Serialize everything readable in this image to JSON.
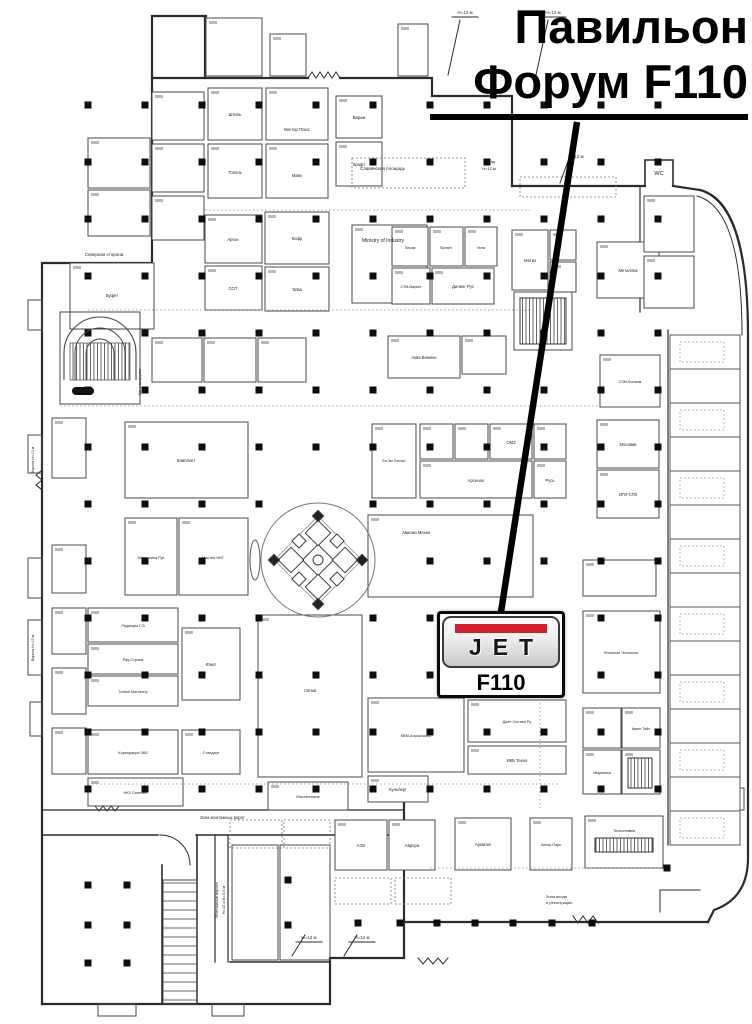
{
  "title": {
    "line1": "Павильон",
    "line2": "Форум F110"
  },
  "stand": {
    "brand": "JET",
    "number": "F110",
    "red": "#cf1f2f"
  },
  "callout": {
    "x1": 577,
    "y1": 122,
    "x2": 501,
    "y2": 612
  },
  "map": {
    "ink": "#2b2b2b",
    "booth_ink": "#4a4a4a",
    "walls": [
      {
        "d": "M205,16 L205,78"
      },
      {
        "d": "M152,16 L206,16"
      },
      {
        "d": "M152,16 L152,263 L42,263 L42,1004"
      },
      {
        "d": "M152,78 L308,78"
      },
      {
        "d": "M308,78 l4,-6 4,6 4,-6 4,6 4,-6 4,6 4,-6 4,6",
        "w": 1
      },
      {
        "d": "M340,78 L432,78 L432,96 L512,96 L512,186"
      },
      {
        "d": "M512,186 L645,186 M673,186 L700,190"
      },
      {
        "d": "M700,190 Q748,202 748,335 L748,858 Q748,898 714,910 L708,922"
      },
      {
        "d": "M697,196 Q742,208 742,335",
        "w": 1
      },
      {
        "d": "M708,922 L404,922"
      },
      {
        "d": "M573,916 l5,7 5,-7 5,7 5,-7 5,7",
        "w": 1
      },
      {
        "d": "M404,778 L404,958 L330,958 L330,1004 L42,1004"
      },
      {
        "d": "M42,810 L404,810",
        "w": 1.2
      },
      {
        "d": "M42,835 L158,835 M196,835 L404,835",
        "w": 1.6
      },
      {
        "d": "M160,835 A30,30 0 0 1 190,865",
        "w": 1
      },
      {
        "d": "M162,865 L162,1004",
        "w": 1.6
      },
      {
        "d": "M197,835 L197,1004",
        "w": 1.6
      },
      {
        "d": "M215,835 L215,962 M228,835 L228,962",
        "w": 1.2
      },
      {
        "d": "M230,962 L330,962",
        "w": 1.6
      },
      {
        "d": "M640,186 L640,312",
        "w": 1.2
      },
      {
        "d": "M668,330 L668,845",
        "w": 1.2
      },
      {
        "d": "M460,20 L448,75 M548,20 L536,75 M572,150 L560,183 M305,935 L292,956 M357,935 L344,956",
        "w": 1
      },
      {
        "d": "M452,17 L478,17 M540,17 L566,17 M296,942 L322,942 M349,942 L375,942",
        "w": 1
      },
      {
        "d": "M418,958 l5,6 5,-6 5,6 5,-6 5,6 5,-6",
        "w": 1
      },
      {
        "d": "M42,470 l-6,5 6,5 -6,5 6,5",
        "w": 1
      },
      {
        "d": "M660,890 L660,912 M660,890 L700,890",
        "w": 1
      },
      {
        "d": "M645,186 L645,160 L673,160 L673,186",
        "w": 1.6
      },
      {
        "d": "M95,806 l4,5 4,-5 4,5 4,-5 4,5 4,-5",
        "w": 1
      }
    ],
    "booths": [
      [
        152,
        92,
        52,
        48
      ],
      [
        152,
        144,
        52,
        48
      ],
      [
        152,
        196,
        52,
        44
      ],
      [
        88,
        138,
        62,
        50
      ],
      [
        88,
        190,
        62,
        46
      ],
      [
        70,
        263,
        84,
        66
      ],
      [
        208,
        88,
        54,
        52
      ],
      [
        266,
        88,
        62,
        52
      ],
      [
        336,
        96,
        46,
        42
      ],
      [
        208,
        144,
        54,
        54
      ],
      [
        266,
        144,
        62,
        54
      ],
      [
        336,
        142,
        46,
        44
      ],
      [
        206,
        18,
        56,
        58
      ],
      [
        270,
        34,
        36,
        42
      ],
      [
        398,
        24,
        30,
        52
      ],
      [
        205,
        215,
        57,
        48
      ],
      [
        205,
        266,
        57,
        44
      ],
      [
        265,
        212,
        64,
        52
      ],
      [
        265,
        267,
        64,
        44
      ],
      [
        352,
        225,
        75,
        78
      ],
      [
        392,
        227,
        36,
        39
      ],
      [
        430,
        227,
        33,
        39
      ],
      [
        465,
        227,
        32,
        39
      ],
      [
        392,
        268,
        38,
        36
      ],
      [
        432,
        268,
        62,
        36
      ],
      [
        512,
        230,
        36,
        60
      ],
      [
        550,
        230,
        26,
        30
      ],
      [
        550,
        262,
        26,
        30
      ],
      [
        597,
        242,
        62,
        56
      ],
      [
        644,
        196,
        50,
        56
      ],
      [
        644,
        256,
        50,
        52
      ],
      [
        600,
        355,
        60,
        52
      ],
      [
        597,
        420,
        62,
        48
      ],
      [
        597,
        470,
        62,
        48
      ],
      [
        152,
        338,
        50,
        44
      ],
      [
        204,
        338,
        52,
        44
      ],
      [
        258,
        338,
        48,
        44
      ],
      [
        388,
        336,
        72,
        42
      ],
      [
        462,
        336,
        44,
        38
      ],
      [
        125,
        422,
        123,
        76
      ],
      [
        125,
        518,
        52,
        77
      ],
      [
        179,
        518,
        69,
        77
      ],
      [
        52,
        418,
        34,
        60
      ],
      [
        52,
        545,
        34,
        48
      ],
      [
        52,
        608,
        34,
        46
      ],
      [
        52,
        668,
        34,
        46
      ],
      [
        52,
        728,
        34,
        46
      ],
      [
        88,
        608,
        90,
        34
      ],
      [
        88,
        644,
        90,
        30
      ],
      [
        88,
        676,
        90,
        30
      ],
      [
        182,
        628,
        58,
        72
      ],
      [
        88,
        730,
        90,
        44
      ],
      [
        182,
        730,
        58,
        44
      ],
      [
        88,
        778,
        95,
        28
      ],
      [
        268,
        782,
        80,
        28
      ],
      [
        258,
        615,
        104,
        162
      ],
      [
        368,
        515,
        165,
        82
      ],
      [
        372,
        424,
        44,
        74
      ],
      [
        420,
        424,
        33,
        35
      ],
      [
        455,
        424,
        33,
        35
      ],
      [
        490,
        424,
        42,
        35
      ],
      [
        420,
        461,
        112,
        37
      ],
      [
        534,
        461,
        32,
        37
      ],
      [
        534,
        424,
        32,
        35
      ],
      [
        583,
        560,
        73,
        36
      ],
      [
        583,
        611,
        77,
        82
      ],
      [
        583,
        708,
        38,
        40
      ],
      [
        622,
        708,
        38,
        40
      ],
      [
        583,
        750,
        38,
        44
      ],
      [
        622,
        750,
        38,
        44
      ],
      [
        368,
        698,
        96,
        74
      ],
      [
        468,
        700,
        98,
        42
      ],
      [
        368,
        776,
        60,
        26
      ],
      [
        468,
        746,
        98,
        28
      ],
      [
        335,
        820,
        52,
        50
      ],
      [
        389,
        820,
        46,
        50
      ],
      [
        455,
        818,
        56,
        52
      ],
      [
        530,
        818,
        42,
        52
      ],
      [
        585,
        816,
        78,
        52
      ],
      [
        700,
        788,
        44,
        22
      ]
    ],
    "plain": [
      [
        60,
        312,
        80,
        92
      ],
      [
        232,
        845,
        46,
        115
      ],
      [
        280,
        845,
        50,
        115
      ],
      [
        98,
        1004,
        38,
        12
      ],
      [
        212,
        1004,
        32,
        12
      ],
      [
        28,
        300,
        14,
        30
      ],
      [
        28,
        435,
        14,
        38
      ],
      [
        28,
        558,
        14,
        40
      ],
      [
        28,
        620,
        14,
        55
      ],
      [
        30,
        702,
        12,
        34
      ],
      [
        514,
        292,
        58,
        58
      ]
    ],
    "dashed": [
      [
        352,
        158,
        113,
        30
      ],
      [
        520,
        177,
        96,
        20
      ],
      [
        230,
        820,
        52,
        28
      ],
      [
        284,
        820,
        46,
        28
      ],
      [
        335,
        878,
        56,
        26
      ],
      [
        395,
        878,
        56,
        26
      ]
    ],
    "hatched": [
      [
        520,
        298,
        46,
        46
      ],
      [
        595,
        838,
        58,
        14
      ],
      [
        628,
        758,
        24,
        30
      ]
    ],
    "rungs": [
      [
        163,
        880,
        34,
        124
      ]
    ],
    "dotted": [
      [
        88,
        310,
        530,
        310
      ],
      [
        60,
        406,
        600,
        406
      ],
      [
        88,
        784,
        560,
        784
      ],
      [
        430,
        868,
        660,
        868
      ],
      [
        540,
        615,
        540,
        808
      ],
      [
        205,
        210,
        530,
        210
      ]
    ],
    "stalls": {
      "x": 670,
      "y0": 335,
      "w": 70,
      "h": 34,
      "count": 15
    },
    "pillars": {
      "xs": [
        88,
        145,
        202,
        259,
        316,
        373,
        430,
        487,
        544,
        601,
        658
      ],
      "ys": [
        105,
        162,
        219,
        276,
        333,
        390,
        447,
        504,
        561,
        618,
        675,
        732,
        789
      ],
      "extra": [
        [
          88,
          885
        ],
        [
          127,
          885
        ],
        [
          88,
          925
        ],
        [
          127,
          925
        ],
        [
          88,
          963
        ],
        [
          127,
          963
        ],
        [
          288,
          880
        ],
        [
          288,
          925
        ],
        [
          358,
          923
        ],
        [
          400,
          923
        ],
        [
          437,
          923
        ],
        [
          475,
          923
        ],
        [
          513,
          923
        ],
        [
          552,
          923
        ],
        [
          592,
          923
        ],
        [
          667,
          868
        ]
      ],
      "skip_center": {
        "cx": 318,
        "cy": 560,
        "r": 75
      }
    },
    "labels": [
      {
        "t": "Северная сторона",
        "x": 104,
        "y": 256,
        "s": 4.5
      },
      {
        "t": "Буфет",
        "x": 112,
        "y": 297
      },
      {
        "t": "Славянская площадь",
        "x": 360,
        "y": 170,
        "s": 4.5,
        "a": "start"
      },
      {
        "t": "Выезд",
        "x": 489,
        "y": 163,
        "s": 4
      },
      {
        "t": "H=12 м",
        "x": 489,
        "y": 170,
        "s": 4
      },
      {
        "t": "H=12 м",
        "x": 465,
        "y": 14,
        "s": 4.5
      },
      {
        "t": "H=12 м",
        "x": 553,
        "y": 14,
        "s": 4.5
      },
      {
        "t": "H=12 м",
        "x": 576,
        "y": 158,
        "s": 4.5
      },
      {
        "t": "H=12 м",
        "x": 309,
        "y": 939,
        "s": 4.5
      },
      {
        "t": "H=12 м",
        "x": 362,
        "y": 939,
        "s": 4.5
      },
      {
        "t": "WC",
        "x": 659,
        "y": 175,
        "s": 5.5
      },
      {
        "t": "Зона входа",
        "x": 546,
        "y": 898,
        "s": 4,
        "a": "start"
      },
      {
        "t": "и регистрации",
        "x": 546,
        "y": 904,
        "s": 4,
        "a": "start"
      },
      {
        "t": "Зона монтажных ворот",
        "x": 200,
        "y": 819,
        "s": 4.2,
        "a": "start"
      },
      {
        "t": "Монтажные ворота",
        "x": 218,
        "y": 900,
        "s": 4,
        "r": -90
      },
      {
        "t": "H=12 и B=3,5 м",
        "x": 225,
        "y": 900,
        "s": 4,
        "r": -90
      },
      {
        "t": "Зона выгрузки",
        "x": 141,
        "y": 382,
        "s": 4,
        "r": -90
      },
      {
        "t": "Ворота H=12 м",
        "x": 34,
        "y": 460,
        "s": 3.8,
        "r": -90
      },
      {
        "t": "Ворота H=12 м",
        "x": 34,
        "y": 648,
        "s": 3.8,
        "r": -90
      },
      {
        "t": "Ministry of Industry",
        "x": 362,
        "y": 242,
        "s": 5,
        "a": "start"
      },
      {
        "t": "Штиль",
        "x": 235,
        "y": 116
      },
      {
        "t": "Вектор Плюс",
        "x": 297,
        "y": 131
      },
      {
        "t": "Вираж",
        "x": 359,
        "y": 119
      },
      {
        "t": "Тополь",
        "x": 235,
        "y": 174
      },
      {
        "t": "Маяк",
        "x": 297,
        "y": 177
      },
      {
        "t": "Крафт",
        "x": 359,
        "y": 166
      },
      {
        "t": "Аргон",
        "x": 233,
        "y": 241
      },
      {
        "t": "Кофр",
        "x": 297,
        "y": 240
      },
      {
        "t": "СОТ",
        "x": 233,
        "y": 290
      },
      {
        "t": "Элва",
        "x": 297,
        "y": 291
      },
      {
        "t": "Элком",
        "x": 410,
        "y": 249,
        "s": 3.6
      },
      {
        "t": "Палант",
        "x": 446,
        "y": 249,
        "s": 3.6
      },
      {
        "t": "Нота",
        "x": 481,
        "y": 249,
        "s": 3.6
      },
      {
        "t": "СТМ-Маркет",
        "x": 411,
        "y": 288,
        "s": 3.6
      },
      {
        "t": "Дилинг Рус",
        "x": 463,
        "y": 288
      },
      {
        "t": "Метиз",
        "x": 530,
        "y": 262
      },
      {
        "t": "Металлик",
        "x": 628,
        "y": 272
      },
      {
        "t": "СЗМ-Консим",
        "x": 630,
        "y": 383,
        "s": 3.8
      },
      {
        "t": "Мосавив",
        "x": 628,
        "y": 446
      },
      {
        "t": "ИГИ-СПб",
        "x": 628,
        "y": 496
      },
      {
        "t": "Аква Вижион",
        "x": 424,
        "y": 359
      },
      {
        "t": "Комплект",
        "x": 186,
        "y": 462
      },
      {
        "t": "Металлика Рус",
        "x": 151,
        "y": 559,
        "s": 3.8
      },
      {
        "t": "Мастен-НБТ",
        "x": 213,
        "y": 559,
        "s": 3.8
      },
      {
        "t": "Би-Эм Сигнал",
        "x": 394,
        "y": 462,
        "s": 3.5
      },
      {
        "t": "Арсенал",
        "x": 476,
        "y": 482
      },
      {
        "t": "Русь",
        "x": 550,
        "y": 482
      },
      {
        "t": "ОМЗ",
        "x": 511,
        "y": 444
      },
      {
        "t": "Ависма Механ",
        "x": 402,
        "y": 534,
        "a": "start"
      },
      {
        "t": "Сигма",
        "x": 310,
        "y": 692
      },
      {
        "t": "Редакция СЭ",
        "x": 133,
        "y": 627,
        "s": 3.8
      },
      {
        "t": "Рау-Строев",
        "x": 133,
        "y": 661,
        "s": 3.8
      },
      {
        "t": "Turkish Machinery",
        "x": 133,
        "y": 693,
        "s": 3.6
      },
      {
        "t": "Юнит",
        "x": 211,
        "y": 666
      },
      {
        "t": "Корпорация ЗКБ",
        "x": 133,
        "y": 754,
        "s": 3.8
      },
      {
        "t": "Стандарт",
        "x": 211,
        "y": 754,
        "s": 3.8
      },
      {
        "t": "НКЗ Сантехн",
        "x": 135,
        "y": 794,
        "s": 3.8
      },
      {
        "t": "Мастенников",
        "x": 308,
        "y": 798,
        "s": 3.8
      },
      {
        "t": "КВМ-Аэрокосмос",
        "x": 416,
        "y": 737,
        "s": 3.8
      },
      {
        "t": "Джет Систем Ру",
        "x": 517,
        "y": 723,
        "s": 3.8
      },
      {
        "t": "Кульберг",
        "x": 398,
        "y": 791
      },
      {
        "t": "ИКБ Техно",
        "x": 517,
        "y": 762
      },
      {
        "t": "Легальные Технологии",
        "x": 621,
        "y": 654,
        "s": 3.2
      },
      {
        "t": "Авант Тайл",
        "x": 641,
        "y": 730,
        "s": 3.5
      },
      {
        "t": "Медиатика",
        "x": 602,
        "y": 774,
        "s": 3.5
      },
      {
        "t": "АЭЗ",
        "x": 361,
        "y": 847
      },
      {
        "t": "Аврора",
        "x": 412,
        "y": 847
      },
      {
        "t": "Арматек",
        "x": 483,
        "y": 846
      },
      {
        "t": "Автор Парк",
        "x": 551,
        "y": 846,
        "s": 3.8
      },
      {
        "t": "Технолемма",
        "x": 624,
        "y": 832,
        "s": 3.8
      }
    ]
  }
}
